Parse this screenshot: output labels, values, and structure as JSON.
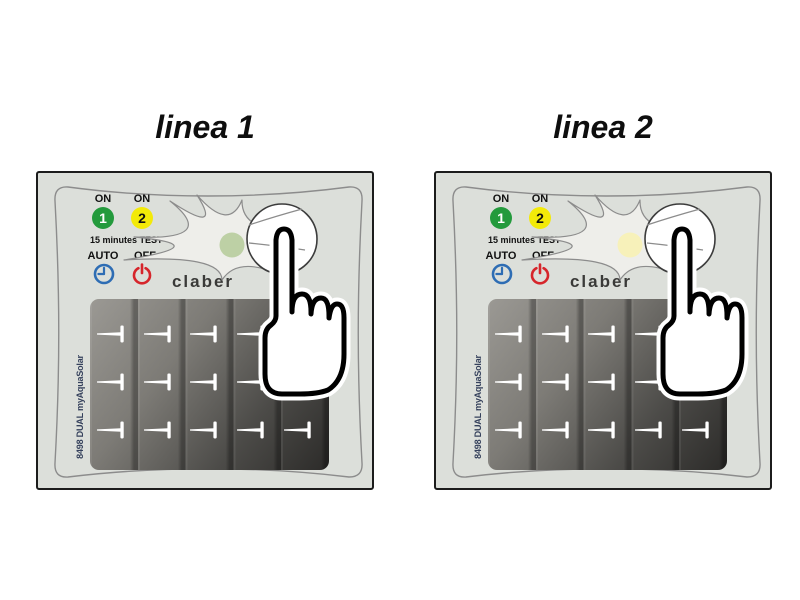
{
  "figure": {
    "panels": [
      {
        "title": "linea 1",
        "led_color": "#bdd0a5"
      },
      {
        "title": "linea 2",
        "led_color": "#f7f1ba"
      }
    ],
    "device": {
      "on_label": "ON",
      "line1_number": "1",
      "line2_number": "2",
      "test_label": "15 minutes TEST",
      "auto_label": "AUTO",
      "off_label": "OFF",
      "brand": "claber",
      "model_text": "8498 DUAL myAquaSolar"
    },
    "colors": {
      "device_bg": "#dcdfda",
      "device_border": "#1c1c1c",
      "line1_button": "#239a3c",
      "line2_button": "#f3ea08",
      "auto_icon": "#2e6db4",
      "off_icon": "#d6252b",
      "led_line1": "#bdd0a5",
      "led_line2": "#f7f1ba",
      "solar_light": "#9b9994",
      "solar_dark": "#2c2b29",
      "brand_color": "#3a3a38"
    }
  }
}
